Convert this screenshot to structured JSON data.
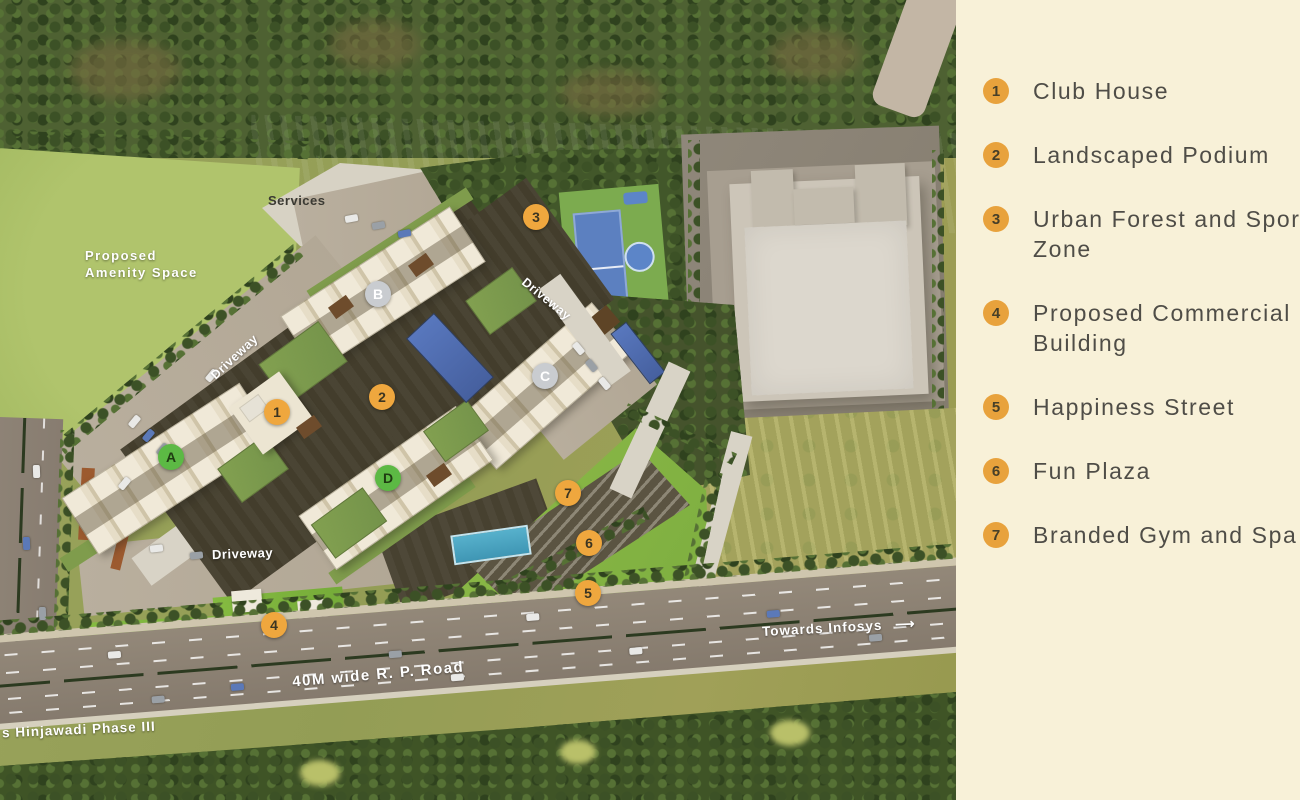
{
  "legend": {
    "items": [
      {
        "num": "1",
        "label": "Club House"
      },
      {
        "num": "2",
        "label": "Landscaped Podium"
      },
      {
        "num": "3",
        "label": "Urban Forest and Sports Zone"
      },
      {
        "num": "4",
        "label": "Proposed Commercial Building"
      },
      {
        "num": "5",
        "label": "Happiness Street"
      },
      {
        "num": "6",
        "label": "Fun Plaza"
      },
      {
        "num": "7",
        "label": "Branded Gym and Spa"
      }
    ]
  },
  "map": {
    "labels": {
      "services": "Services",
      "amenity_line1": "Proposed",
      "amenity_line2": "Amenity Space",
      "driveway": "Driveway",
      "road_name": "40M wide R. P. Road",
      "towards_infosys": "Towards Infosys",
      "towards_infosys_arrow": "⟶",
      "hinjawadi": "s Hinjawadi Phase III"
    },
    "tower_markers": [
      {
        "label": "A"
      },
      {
        "label": "B"
      },
      {
        "label": "C"
      },
      {
        "label": "D"
      }
    ],
    "site_markers": [
      {
        "label": "1"
      },
      {
        "label": "2"
      },
      {
        "label": "3"
      },
      {
        "label": "4"
      },
      {
        "label": "5"
      },
      {
        "label": "6"
      },
      {
        "label": "7"
      }
    ]
  },
  "colors": {
    "legend_background": "#f8f1d8",
    "legend_marker_orange": "#e8a23c",
    "legend_text": "#4f4d47",
    "map_marker_orange": "#efa73e",
    "tower_marker_green": "#5cb944",
    "tower_marker_gray": "#c9ccd0",
    "field_green": "#a7bd62",
    "terrace_green": "#8fbc49",
    "forest_green": "#42572a",
    "meadow_olive": "#a3a25c",
    "road_gray": "#8b8073",
    "pool_blue": "#5877bd",
    "pool_teal": "#57b1cc"
  }
}
